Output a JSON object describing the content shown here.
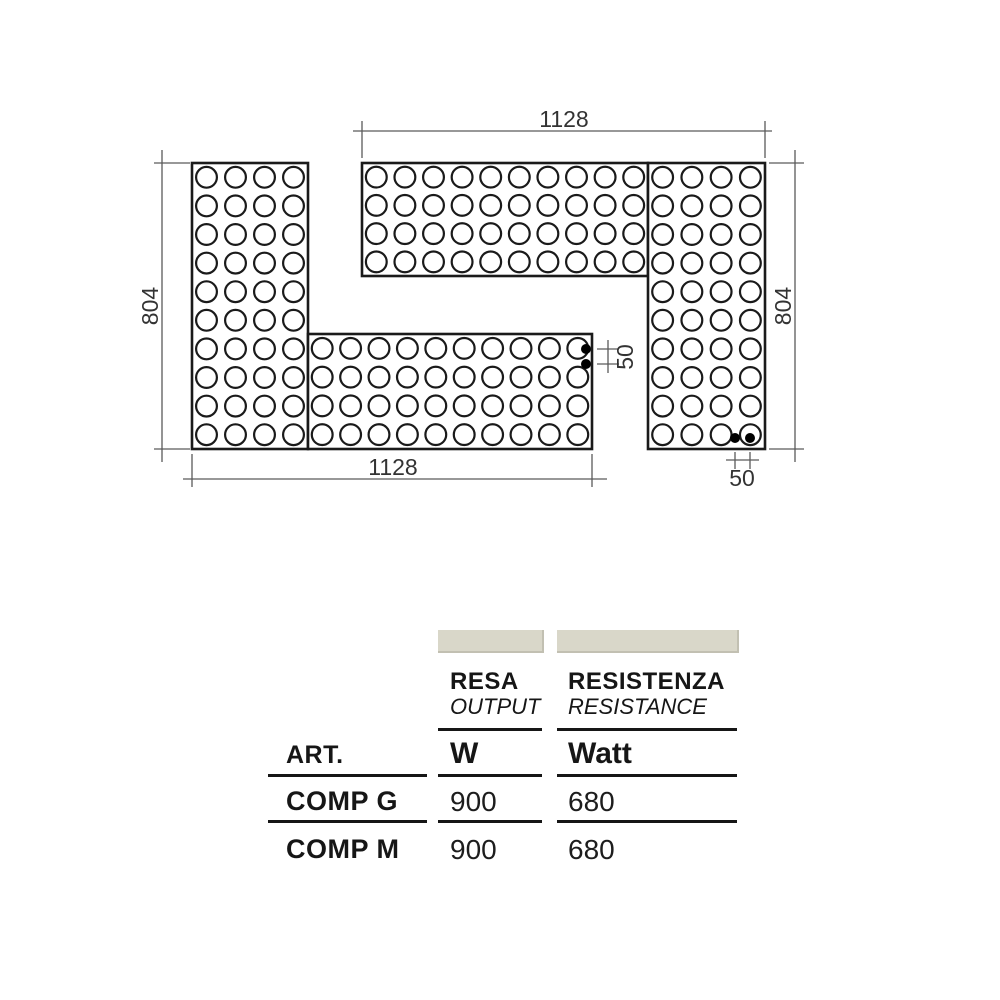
{
  "diagram": {
    "outline_color": "#1a1a1a",
    "dim_line_color": "#5a5a5a",
    "dim_text_color": "#333333",
    "dot_color": "#000000",
    "dim_font_size": 23,
    "circle_radius": 10.4,
    "panels": [
      {
        "name": "left-module-vertical-bar",
        "x": 192,
        "y": 163,
        "w": 116,
        "h": 286,
        "cols": 4,
        "rows": 10
      },
      {
        "name": "left-module-bottom-arm",
        "x": 308,
        "y": 334,
        "w": 284,
        "h": 115,
        "cols": 10,
        "rows": 4
      },
      {
        "name": "right-module-top-arm",
        "x": 362,
        "y": 163,
        "w": 286,
        "h": 113,
        "cols": 10,
        "rows": 4
      },
      {
        "name": "right-module-vertical-bar",
        "x": 648,
        "y": 163,
        "w": 117,
        "h": 286,
        "cols": 4,
        "rows": 10
      }
    ],
    "connection_dots": [
      {
        "x": 586,
        "y": 349
      },
      {
        "x": 586,
        "y": 364
      },
      {
        "x": 735,
        "y": 438
      },
      {
        "x": 750,
        "y": 438
      }
    ],
    "dimensions": [
      {
        "label": "1128",
        "text": {
          "x": 564,
          "y": 127,
          "rot": 0
        },
        "lines": [
          [
            353,
            131,
            772,
            131
          ],
          [
            362,
            121,
            362,
            158
          ],
          [
            765,
            121,
            765,
            158
          ]
        ]
      },
      {
        "label": "1128",
        "text": {
          "x": 393,
          "y": 475,
          "rot": 0
        },
        "lines": [
          [
            183,
            479,
            607,
            479
          ],
          [
            192,
            454,
            192,
            487
          ],
          [
            592,
            454,
            592,
            487
          ]
        ]
      },
      {
        "label": "804",
        "text": {
          "x": 158,
          "y": 306,
          "rot": -90
        },
        "lines": [
          [
            162,
            150,
            162,
            462
          ],
          [
            154,
            163,
            190,
            163
          ],
          [
            154,
            449,
            190,
            449
          ]
        ]
      },
      {
        "label": "804",
        "text": {
          "x": 791,
          "y": 306,
          "rot": -90
        },
        "lines": [
          [
            795,
            150,
            795,
            462
          ],
          [
            769,
            163,
            804,
            163
          ],
          [
            769,
            449,
            804,
            449
          ]
        ]
      },
      {
        "label": "50",
        "text": {
          "x": 633,
          "y": 357,
          "rot": -90
        },
        "lines": [
          [
            608,
            340,
            608,
            373
          ],
          [
            597,
            349,
            619,
            349
          ],
          [
            597,
            364,
            619,
            364
          ]
        ]
      },
      {
        "label": "50",
        "text": {
          "x": 742,
          "y": 486,
          "rot": 0
        },
        "lines": [
          [
            726,
            460,
            759,
            460
          ],
          [
            735,
            452,
            735,
            469
          ],
          [
            750,
            452,
            750,
            469
          ]
        ]
      }
    ]
  },
  "table": {
    "swatch_color": "#d9d7c9",
    "art_header": "ART.",
    "columns": [
      {
        "title": "RESA",
        "subtitle": "OUTPUT",
        "unit": "W"
      },
      {
        "title": "RESISTENZA",
        "subtitle": "RESISTANCE",
        "unit": "Watt"
      }
    ],
    "rows": [
      {
        "art": "COMP G",
        "resa": "900",
        "resistenza": "680"
      },
      {
        "art": "COMP M",
        "resa": "900",
        "resistenza": "680"
      }
    ]
  }
}
